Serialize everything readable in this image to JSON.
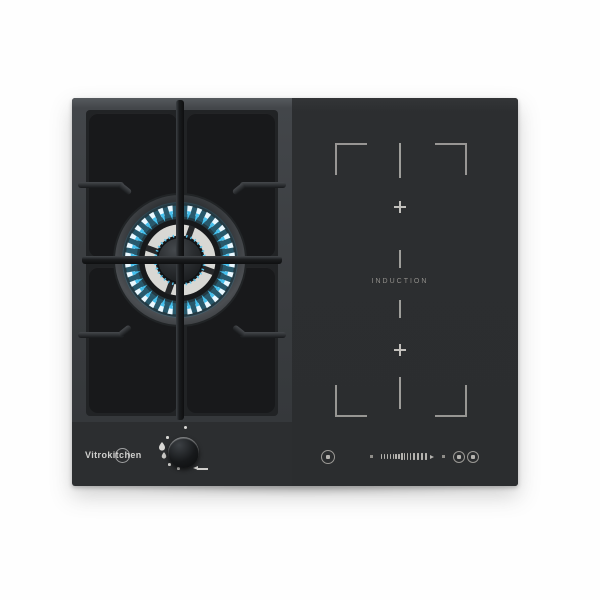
{
  "product": {
    "brand": "Vitrokitchen",
    "type": "combined gas and induction hob"
  },
  "induction": {
    "label": "INDUCTION",
    "zone_markers": [
      "plus",
      "plus"
    ],
    "bracket_corners": 4
  },
  "gas": {
    "burner": "dual-ring-burner-lit",
    "knob_symbols": [
      "off-dot",
      "spark-dot",
      "large-flame",
      "small-flame",
      "low-dot",
      "min-dot",
      "push-arrow-left"
    ]
  },
  "touch_panel": {
    "controls": [
      "power-button",
      "slider-start-marker",
      "power-level-slider",
      "slider-end-marker",
      "timer-button",
      "lock-button"
    ]
  },
  "colors": {
    "glass": "#2c2e30",
    "gas_frame": "#43464a",
    "pan_support": "#1a1c1e",
    "flame_cyan": "#45c2f0",
    "flame_white": "#eaf8ff",
    "marking_gray": "#b3b1ad",
    "background": "#fefefe"
  }
}
